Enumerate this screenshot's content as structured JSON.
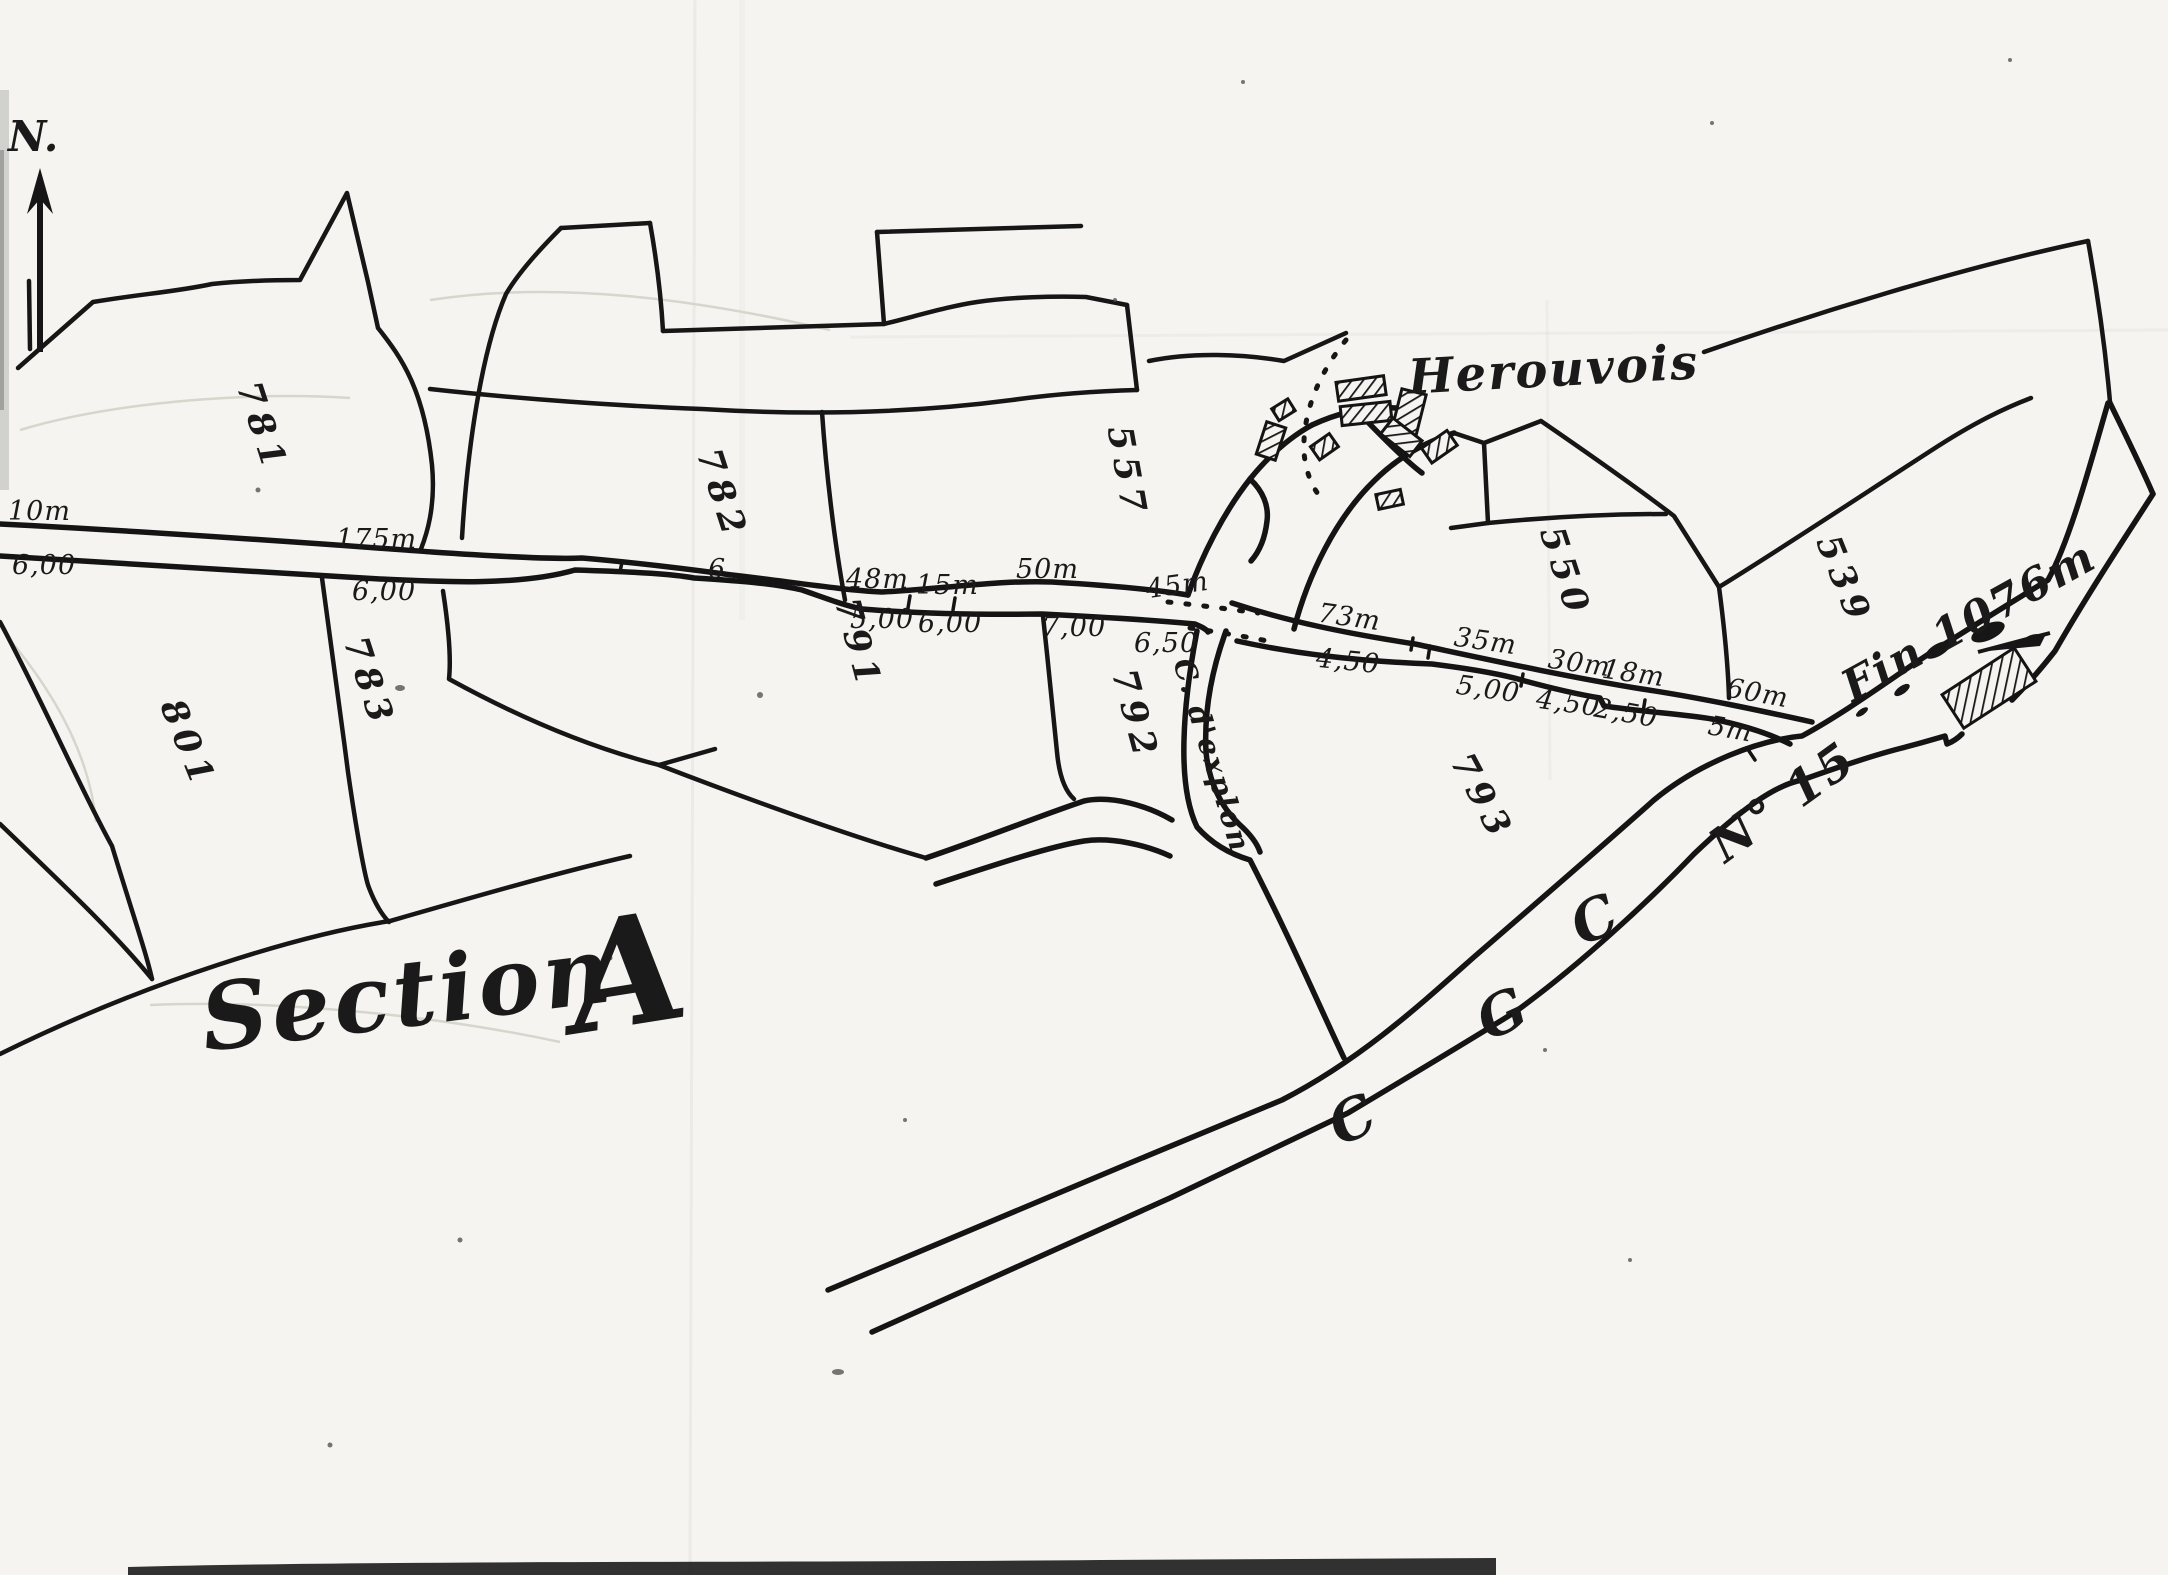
{
  "north": {
    "label": "N."
  },
  "section_title": {
    "word": "Section",
    "letter": "A"
  },
  "hamlet_name": "Herouvois",
  "path_name": "C. d'explon",
  "road": {
    "letter_c1": "C",
    "letter_g": "G",
    "letter_c2": "C",
    "number": "N° 15",
    "end_marker": "Fin 1076m"
  },
  "parcel_numbers": [
    "781",
    "782",
    "557",
    "550",
    "539",
    "801",
    "783",
    "791",
    "792",
    "793"
  ],
  "road_measurements": {
    "west_road": [
      "10m",
      "6,00",
      "175m",
      "6,00",
      "6",
      "48m",
      "15m",
      "50m",
      "45m",
      "5,00",
      "6,00",
      "7,00",
      "6,50"
    ],
    "east_road": [
      "73m",
      "4,50",
      "35m",
      "5,00",
      "30m",
      "4,50",
      "18m",
      "2,50",
      "60m",
      "5m"
    ]
  },
  "ink_color": "#1a1a1a",
  "paper_color": "#f5f4f0"
}
